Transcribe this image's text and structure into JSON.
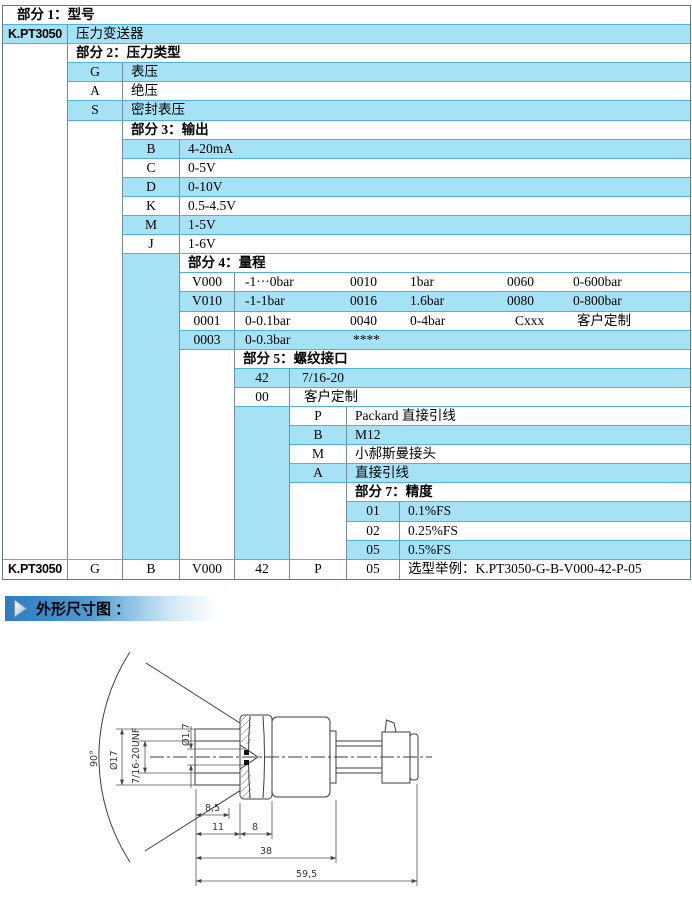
{
  "colors": {
    "row_blue": "#a6e2f6",
    "border_h": "#4fb2da",
    "border_v": "#70909f",
    "outer": "#5e7c8c",
    "banner_blue": "#2b7cc4",
    "banner_fade": "#cfe7f7",
    "line": "#3d3d3d",
    "dim": "#555555"
  },
  "banner": {
    "text": "外形尺寸图 ："
  },
  "table": {
    "col_widths": [
      65,
      55,
      57,
      55,
      55,
      57,
      53,
      290
    ],
    "row_count": 30,
    "row_height": 19.1,
    "cells": [
      {
        "r": 1,
        "c": 1,
        "cs": 8,
        "k": "header",
        "bg": "w",
        "t": "部分 1：型号",
        "pl": 14
      },
      {
        "r": 2,
        "c": 1,
        "k": "model",
        "bg": "b",
        "t": "K.PT3050"
      },
      {
        "r": 2,
        "c": 2,
        "cs": 7,
        "k": "desc",
        "bg": "b",
        "t": "压力变送器"
      },
      {
        "r": 3,
        "c": 1,
        "rs": 27,
        "k": "span",
        "bg": "w"
      },
      {
        "r": 3,
        "c": 2,
        "cs": 7,
        "k": "header",
        "bg": "w",
        "t": "部分 2：压力类型"
      },
      {
        "r": 4,
        "c": 2,
        "k": "code",
        "bg": "b",
        "t": "G"
      },
      {
        "r": 4,
        "c": 3,
        "cs": 6,
        "k": "desc",
        "bg": "b",
        "t": "表压"
      },
      {
        "r": 5,
        "c": 2,
        "k": "code",
        "bg": "w",
        "t": "A"
      },
      {
        "r": 5,
        "c": 3,
        "cs": 6,
        "k": "desc",
        "bg": "w",
        "t": "绝压"
      },
      {
        "r": 6,
        "c": 2,
        "k": "code",
        "bg": "b",
        "t": "S"
      },
      {
        "r": 6,
        "c": 3,
        "cs": 6,
        "k": "desc",
        "bg": "b",
        "t": "密封表压"
      },
      {
        "r": 7,
        "c": 2,
        "rs": 23,
        "k": "span",
        "bg": "w"
      },
      {
        "r": 7,
        "c": 3,
        "cs": 6,
        "k": "header",
        "bg": "w",
        "t": "部分 3：输出"
      },
      {
        "r": 8,
        "c": 3,
        "k": "code",
        "bg": "b",
        "t": "B"
      },
      {
        "r": 8,
        "c": 4,
        "cs": 5,
        "k": "desc",
        "bg": "b",
        "t": "4-20mA"
      },
      {
        "r": 9,
        "c": 3,
        "k": "code",
        "bg": "w",
        "t": "C"
      },
      {
        "r": 9,
        "c": 4,
        "cs": 5,
        "k": "desc",
        "bg": "w",
        "t": "0-5V"
      },
      {
        "r": 10,
        "c": 3,
        "k": "code",
        "bg": "b",
        "t": "D"
      },
      {
        "r": 10,
        "c": 4,
        "cs": 5,
        "k": "desc",
        "bg": "b",
        "t": "0-10V"
      },
      {
        "r": 11,
        "c": 3,
        "k": "code",
        "bg": "w",
        "t": "K"
      },
      {
        "r": 11,
        "c": 4,
        "cs": 5,
        "k": "desc",
        "bg": "w",
        "t": "0.5-4.5V"
      },
      {
        "r": 12,
        "c": 3,
        "k": "code",
        "bg": "b",
        "t": "M"
      },
      {
        "r": 12,
        "c": 4,
        "cs": 5,
        "k": "desc",
        "bg": "b",
        "t": "1-5V"
      },
      {
        "r": 13,
        "c": 3,
        "k": "code",
        "bg": "w",
        "t": "J"
      },
      {
        "r": 13,
        "c": 4,
        "cs": 5,
        "k": "desc",
        "bg": "w",
        "t": "1-6V"
      },
      {
        "r": 14,
        "c": 3,
        "rs": 16,
        "k": "span",
        "bg": "b"
      },
      {
        "r": 14,
        "c": 4,
        "cs": 5,
        "k": "header",
        "bg": "w",
        "t": "部分 4：量程"
      },
      {
        "r": 15,
        "c": 4,
        "k": "code",
        "bg": "w",
        "t": "V000"
      },
      {
        "r": 15,
        "c": 5,
        "cs": 4,
        "k": "desc",
        "bg": "w",
        "parts": [
          {
            "t": "-1···0bar",
            "x": 10
          },
          {
            "t": "0010",
            "x": 115
          },
          {
            "t": "1bar",
            "x": 175
          },
          {
            "t": "0060",
            "x": 272
          },
          {
            "t": "0-600bar",
            "x": 338
          }
        ]
      },
      {
        "r": 16,
        "c": 4,
        "k": "code",
        "bg": "b",
        "t": "V010"
      },
      {
        "r": 16,
        "c": 5,
        "cs": 4,
        "k": "desc",
        "bg": "b",
        "parts": [
          {
            "t": "-1-1bar",
            "x": 10
          },
          {
            "t": "0016",
            "x": 115
          },
          {
            "t": "1.6bar",
            "x": 175
          },
          {
            "t": "0080",
            "x": 272
          },
          {
            "t": "0-800bar",
            "x": 338
          }
        ]
      },
      {
        "r": 17,
        "c": 4,
        "k": "code",
        "bg": "w",
        "t": "0001"
      },
      {
        "r": 17,
        "c": 5,
        "cs": 4,
        "k": "desc",
        "bg": "w",
        "parts": [
          {
            "t": "0-0.1bar",
            "x": 10
          },
          {
            "t": "0040",
            "x": 115
          },
          {
            "t": "0-4bar",
            "x": 175
          },
          {
            "t": "Cxxx",
            "x": 280
          },
          {
            "t": "客户定制",
            "x": 342
          }
        ]
      },
      {
        "r": 18,
        "c": 4,
        "k": "code",
        "bg": "b",
        "t": "0003"
      },
      {
        "r": 18,
        "c": 5,
        "cs": 4,
        "k": "desc",
        "bg": "b",
        "parts": [
          {
            "t": "0-0.3bar",
            "x": 10
          },
          {
            "t": "****",
            "x": 118
          }
        ]
      },
      {
        "r": 19,
        "c": 4,
        "rs": 11,
        "k": "span",
        "bg": "w"
      },
      {
        "r": 19,
        "c": 5,
        "cs": 4,
        "k": "header",
        "bg": "w",
        "t": "部分 5：螺纹接口"
      },
      {
        "r": 20,
        "c": 5,
        "k": "code",
        "bg": "b",
        "t": "42"
      },
      {
        "r": 20,
        "c": 6,
        "cs": 3,
        "k": "desc",
        "bg": "b",
        "t": "7/16-20",
        "pl": 12
      },
      {
        "r": 21,
        "c": 5,
        "k": "code",
        "bg": "w",
        "t": "00"
      },
      {
        "r": 21,
        "c": 6,
        "cs": 3,
        "k": "desc",
        "bg": "w",
        "t": "客户定制",
        "pl": 14
      },
      {
        "r": 22,
        "c": 5,
        "rs": 8,
        "k": "span",
        "bg": "b"
      },
      {
        "r": 22,
        "c": 6,
        "k": "code",
        "bg": "w",
        "t": "P"
      },
      {
        "r": 22,
        "c": 7,
        "cs": 2,
        "k": "desc",
        "bg": "w",
        "t": "Packard 直接引线"
      },
      {
        "r": 23,
        "c": 6,
        "k": "code",
        "bg": "b",
        "t": "B"
      },
      {
        "r": 23,
        "c": 7,
        "cs": 2,
        "k": "desc",
        "bg": "b",
        "t": "M12"
      },
      {
        "r": 24,
        "c": 6,
        "k": "code",
        "bg": "w",
        "t": "M"
      },
      {
        "r": 24,
        "c": 7,
        "cs": 2,
        "k": "desc",
        "bg": "w",
        "t": "小郝斯曼接头"
      },
      {
        "r": 25,
        "c": 6,
        "k": "code",
        "bg": "b",
        "t": "A"
      },
      {
        "r": 25,
        "c": 7,
        "cs": 2,
        "k": "desc",
        "bg": "b",
        "t": "直接引线"
      },
      {
        "r": 26,
        "c": 6,
        "rs": 4,
        "k": "span",
        "bg": "w"
      },
      {
        "r": 26,
        "c": 7,
        "cs": 2,
        "k": "header",
        "bg": "w",
        "t": "部分 7：精度"
      },
      {
        "r": 27,
        "c": 7,
        "k": "code",
        "bg": "b",
        "t": "01"
      },
      {
        "r": 27,
        "c": 8,
        "k": "desc",
        "bg": "b",
        "t": "0.1%FS"
      },
      {
        "r": 28,
        "c": 7,
        "k": "code",
        "bg": "w",
        "t": "02"
      },
      {
        "r": 28,
        "c": 8,
        "k": "desc",
        "bg": "w",
        "t": "0.25%FS"
      },
      {
        "r": 29,
        "c": 7,
        "k": "code",
        "bg": "b",
        "t": "05"
      },
      {
        "r": 29,
        "c": 8,
        "k": "desc",
        "bg": "b",
        "t": "0.5%FS"
      },
      {
        "r": 30,
        "c": 1,
        "k": "model",
        "bg": "w",
        "t": "K.PT3050"
      },
      {
        "r": 30,
        "c": 2,
        "k": "code",
        "bg": "w",
        "t": "G"
      },
      {
        "r": 30,
        "c": 3,
        "k": "code",
        "bg": "w",
        "t": "B"
      },
      {
        "r": 30,
        "c": 4,
        "k": "code",
        "bg": "w",
        "t": "V000"
      },
      {
        "r": 30,
        "c": 5,
        "k": "code",
        "bg": "w",
        "t": "42"
      },
      {
        "r": 30,
        "c": 6,
        "k": "code",
        "bg": "w",
        "t": "P"
      },
      {
        "r": 30,
        "c": 7,
        "k": "code",
        "bg": "w",
        "t": "05"
      },
      {
        "r": 30,
        "c": 8,
        "k": "desc",
        "bg": "w",
        "t": "选型举例：K.PT3050-G-B-V000-42-P-05"
      }
    ]
  },
  "drawing": {
    "dims": {
      "angle": "90°",
      "od": "Ø17",
      "thread": "7/16-20UNF",
      "bore": "Ø1,7",
      "d85": "8,5",
      "d11": "11",
      "d8": "8",
      "d38": "38",
      "d595": "59,5"
    }
  }
}
